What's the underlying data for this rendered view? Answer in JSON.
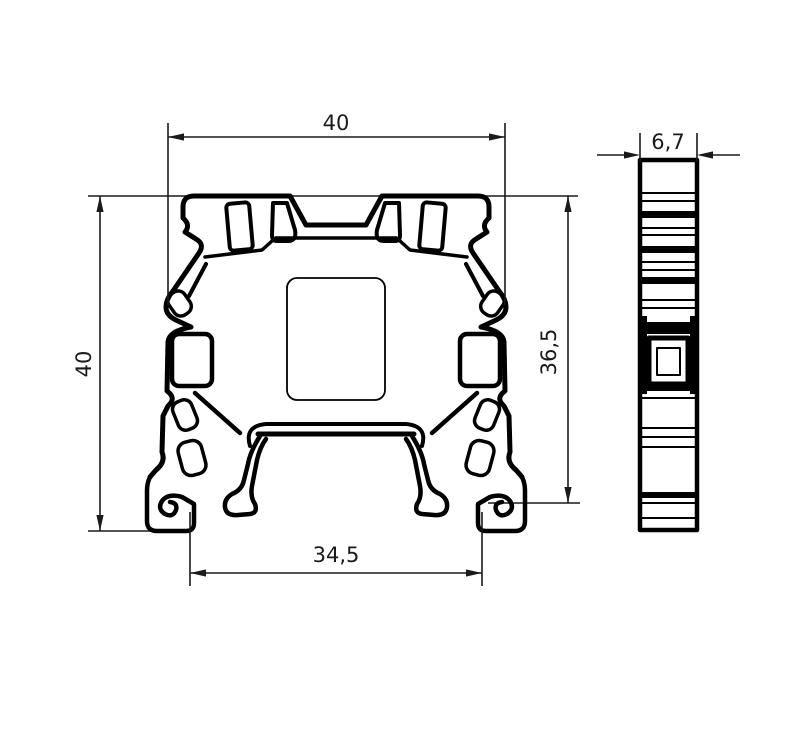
{
  "drawing": {
    "type": "technical-dimension-drawing",
    "subject": "din-rail-terminal-block-profile",
    "views": [
      "front-section",
      "side-view"
    ],
    "units_style": "comma-decimal"
  },
  "dims": {
    "front_width": "40",
    "front_height": "40",
    "front_height_right": "36,5",
    "rail_slot_width": "34,5",
    "side_width": "6,7"
  },
  "colors": {
    "background": "#ffffff",
    "profile_line": "#000000",
    "dimension_line": "#1a1a1a"
  }
}
